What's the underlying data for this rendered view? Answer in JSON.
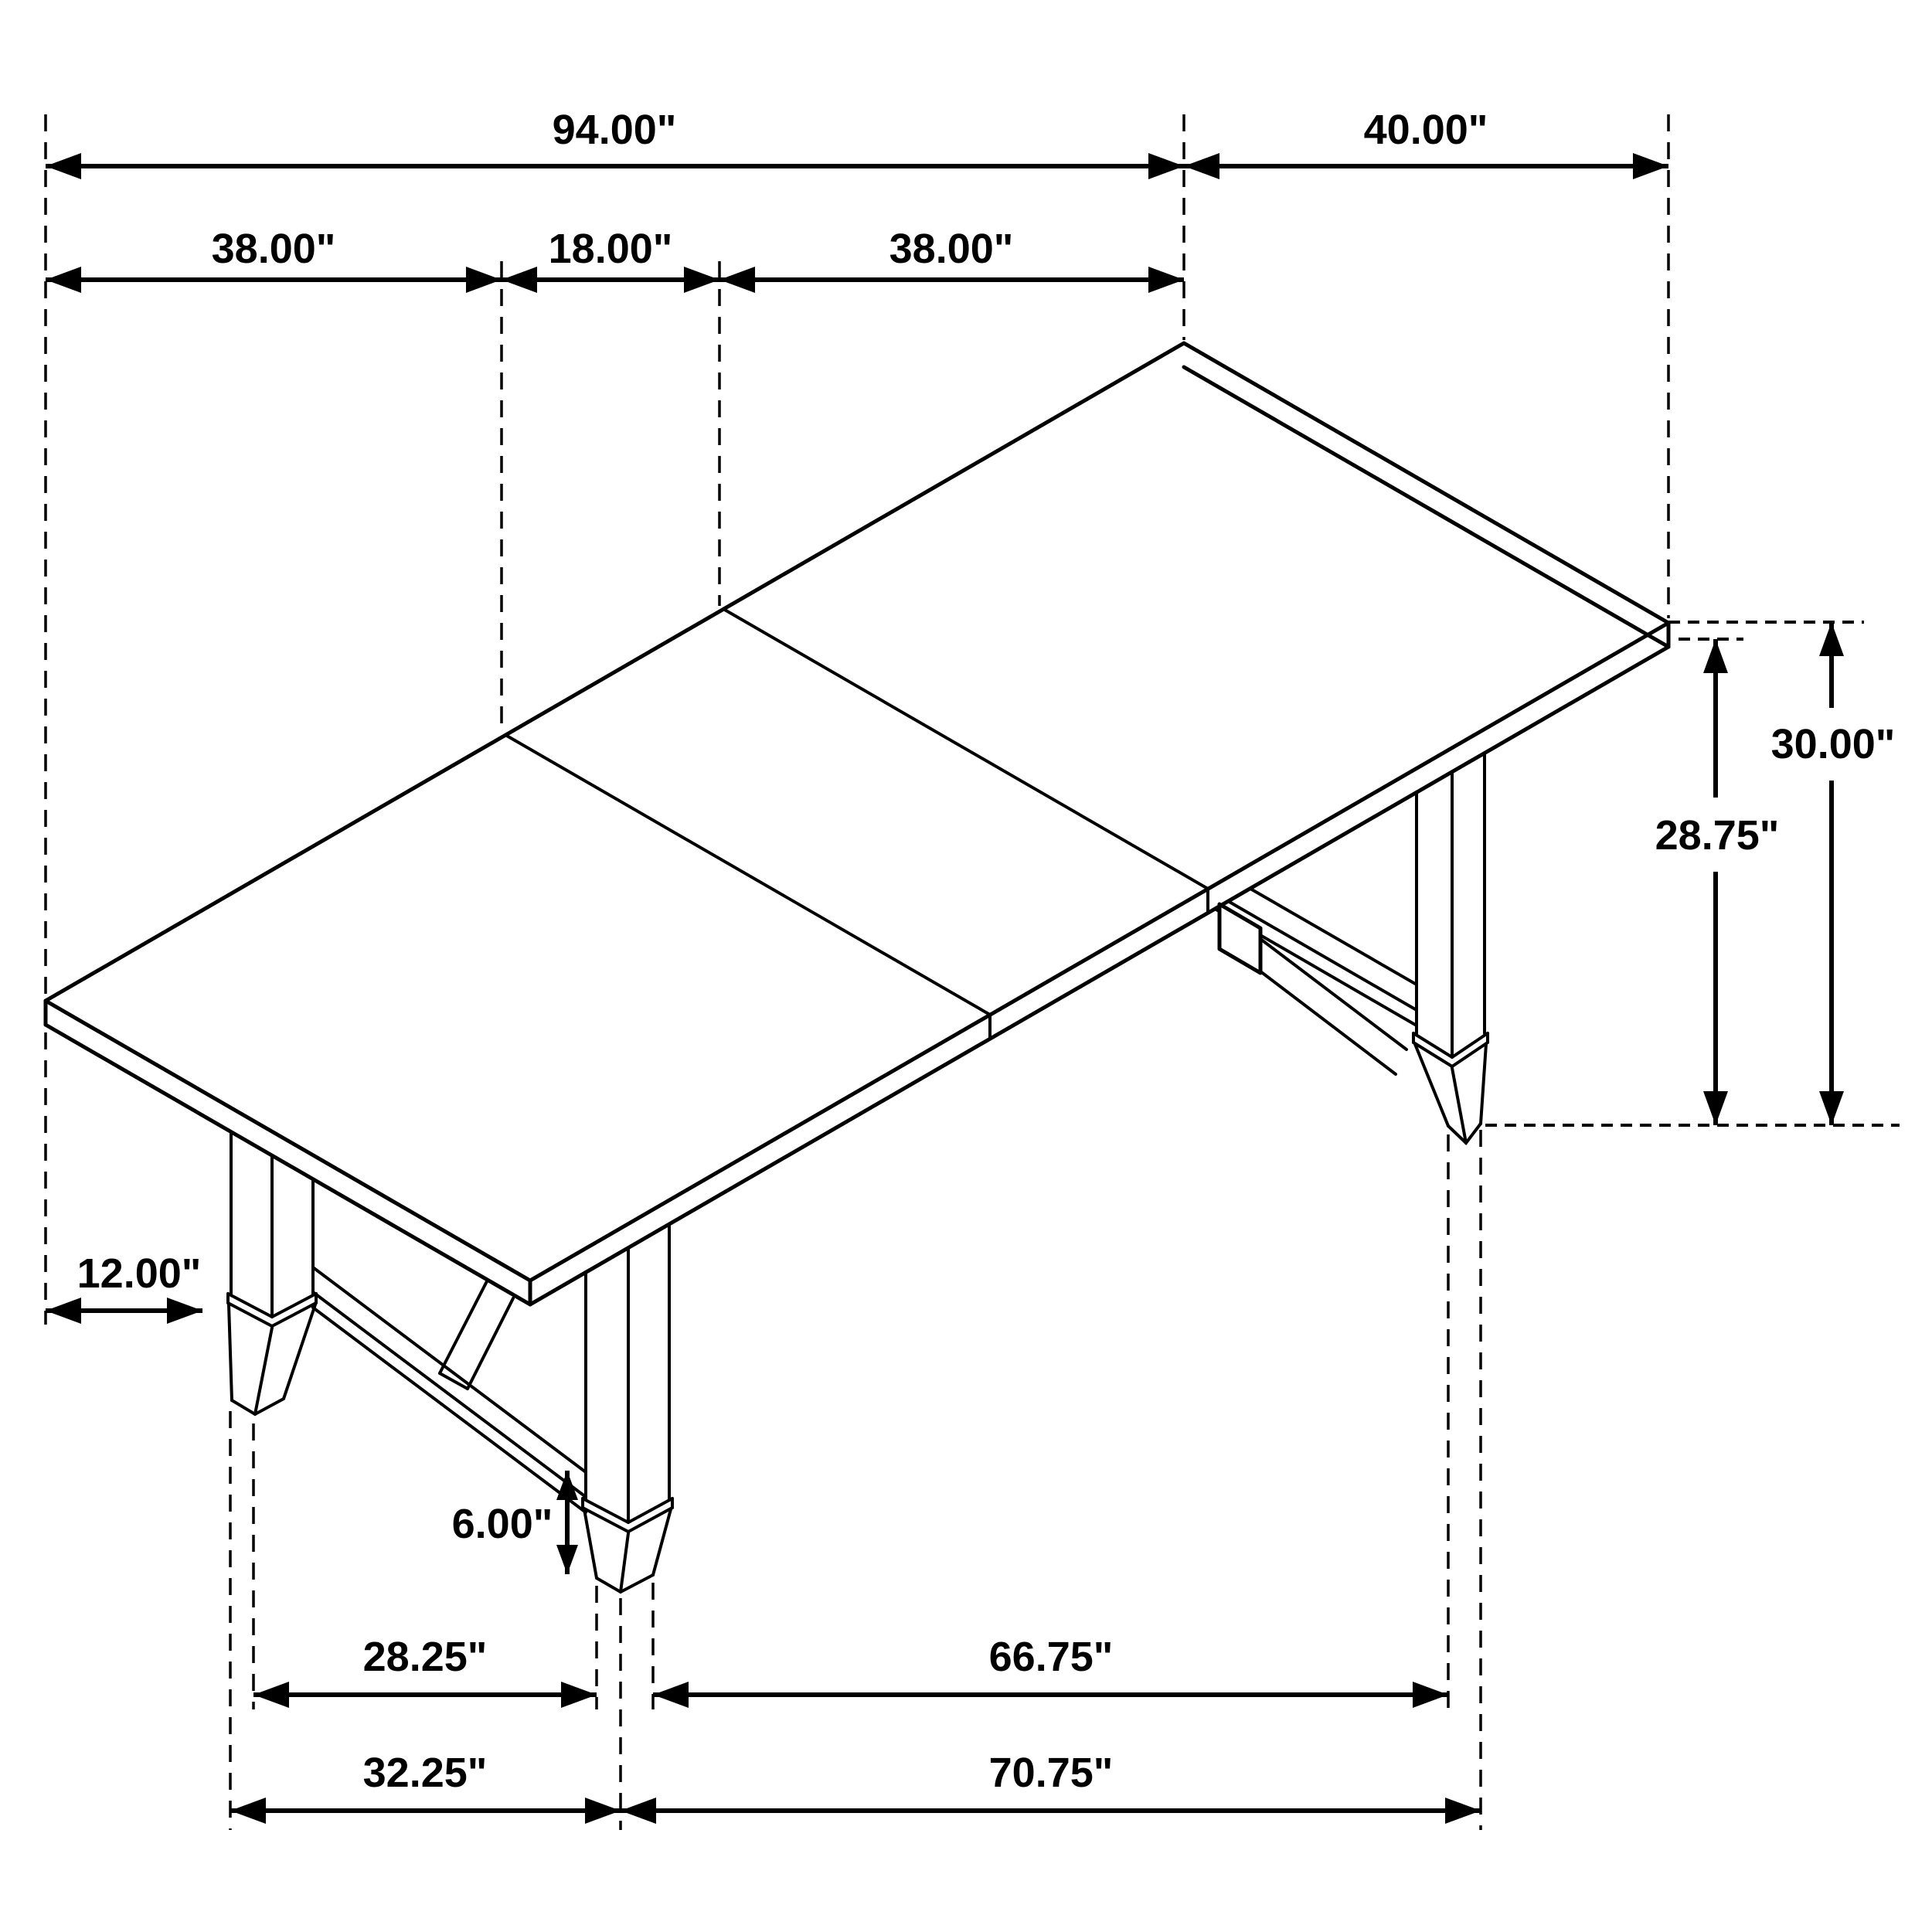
{
  "drawing": {
    "title": "Extension dining table dimension drawing",
    "view": "isometric line drawing",
    "subject": "rectangular dining table with 18-inch extension leaf and trestle legs",
    "unit": "inches",
    "background_color": "#ffffff",
    "line_color": "#000000"
  },
  "dimensions": {
    "overall_length": {
      "label": "94.00\"",
      "value": 94.0
    },
    "table_width": {
      "label": "40.00\"",
      "value": 40.0
    },
    "left_panel_length": {
      "label": "38.00\"",
      "value": 38.0
    },
    "leaf_length": {
      "label": "18.00\"",
      "value": 18.0
    },
    "right_panel_length": {
      "label": "38.00\"",
      "value": 38.0
    },
    "overall_height": {
      "label": "30.00\"",
      "value": 30.0
    },
    "floor_to_underside": {
      "label": "28.75\"",
      "value": 28.75
    },
    "end_overhang": {
      "label": "12.00\"",
      "value": 12.0
    },
    "foot_height": {
      "label": "6.00\"",
      "value": 6.0
    },
    "leg_spacing_inner": {
      "label": "28.25\"",
      "value": 28.25
    },
    "leg_to_leg_span": {
      "label": "66.75\"",
      "value": 66.75
    },
    "leg_spacing_outer": {
      "label": "32.25\"",
      "value": 32.25
    },
    "leg_to_leg_span_outer": {
      "label": "70.75\"",
      "value": 70.75
    }
  }
}
